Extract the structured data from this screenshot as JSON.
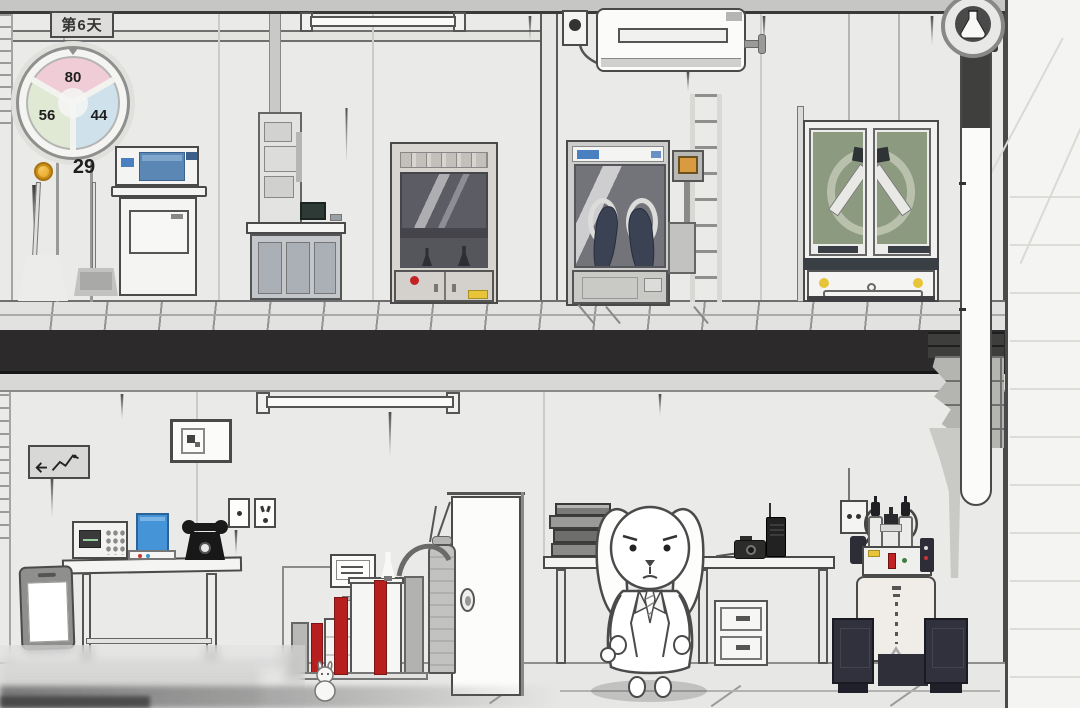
{
  "hud": {
    "day_label": "第6天",
    "gauge": {
      "top": {
        "value": "80",
        "color": "#f0cdd6"
      },
      "left": {
        "value": "56",
        "color": "#e0e9d3"
      },
      "right": {
        "value": "44",
        "color": "#cfe2ec"
      }
    },
    "coins": {
      "count": "29",
      "coin_color": "#e9a71f"
    }
  },
  "palette": {
    "ink": "#4a4a4a",
    "pink": "#f0cdd6",
    "green": "#e0e9d3",
    "blue": "#cfe2ec",
    "coin": "#e9a71f",
    "red": "#b71f1f",
    "devblue": "#4694d8",
    "orange": "#d89b3f",
    "glass": "#8c9a80",
    "navy": "#31313e",
    "glove": "#3a4254",
    "lblue": "#4a7fc0",
    "yellow": "#e8c43a",
    "hazard": "#c32222"
  },
  "scene": {
    "style": "hand-drawn monochrome two-floor laboratory",
    "objects": [
      "day-sign",
      "status-gauge",
      "coin-counter",
      "printer-station",
      "column-analyzer",
      "fume-hood",
      "broom",
      "dustpan",
      "ceiling-lamp",
      "air-conditioner",
      "wall-socket",
      "glovebox",
      "ladder",
      "specimen-cabinet",
      "flask-emblem",
      "level-pipe",
      "exit-sign",
      "picture-frame",
      "power-socket-panel",
      "work-desk",
      "oscilloscope",
      "blue-terminal",
      "rotary-phone",
      "tablet",
      "sample-rack-machine",
      "lab-monitor",
      "gas-tank",
      "door",
      "mini-rabbit-figurine",
      "rabbit-scientist",
      "book-stack",
      "camera",
      "radio",
      "workbench",
      "drawer-cabinet",
      "chemical-synthesizer",
      "speakers",
      "broken-brick-wall"
    ]
  }
}
